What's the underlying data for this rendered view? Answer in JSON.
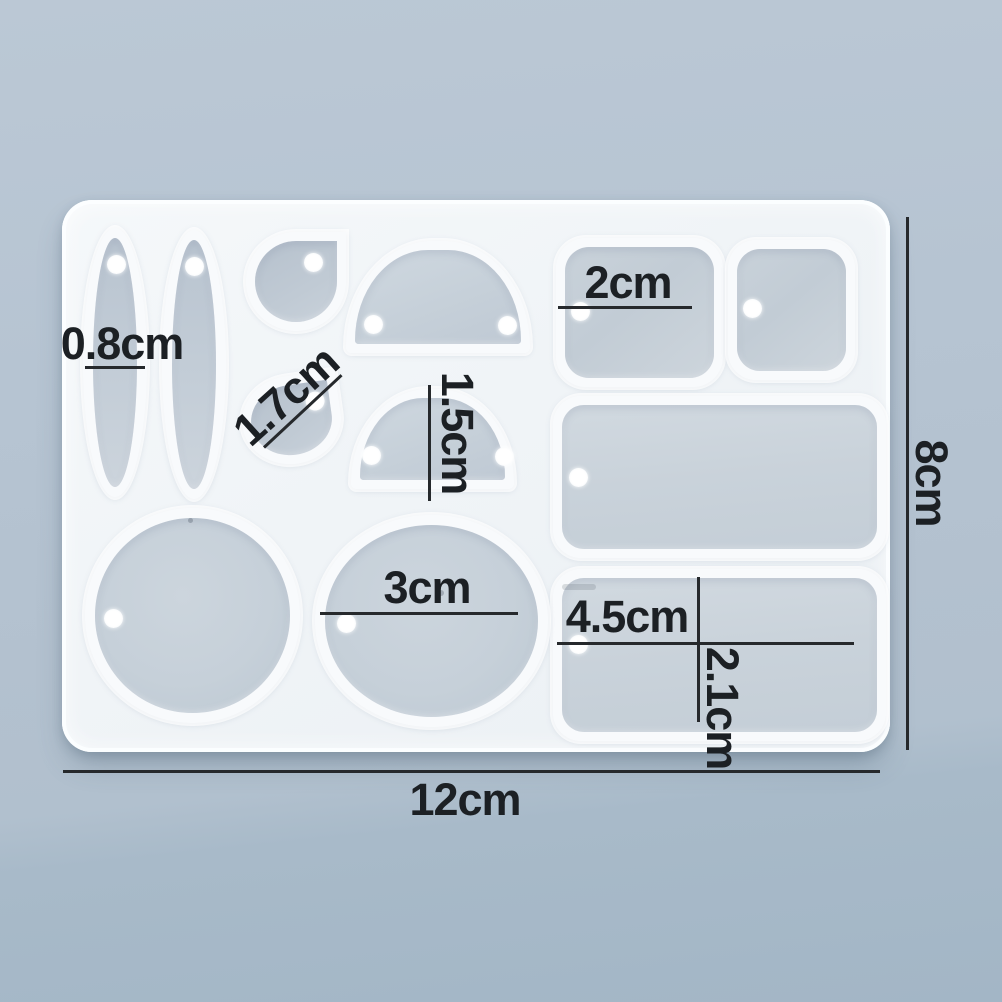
{
  "annotations": {
    "bar_width": "0.8cm",
    "teardrop_size": "1.7cm",
    "arch_width": "1.5cm",
    "square_size": "2cm",
    "circle_diameter": "3cm",
    "tag_width": "4.5cm",
    "tag_height": "2.1cm",
    "mold_width": "12cm",
    "mold_height": "8cm"
  },
  "colors": {
    "background_top": "#bbc8d5",
    "background_bottom": "#a3b6c6",
    "mold_body": "#f0f4f7",
    "cavity_fill": "#c6d0d9",
    "cavity_rim": "#f8fafc",
    "dimension_line": "#26292c",
    "label_text": "#1c2024"
  }
}
